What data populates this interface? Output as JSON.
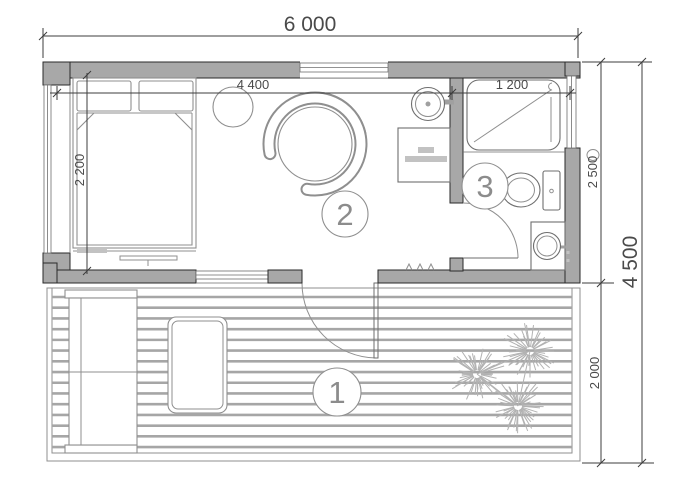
{
  "drawing": {
    "type": "architectural-floor-plan",
    "dimension_labels": {
      "width_total": "6 000",
      "interior_width": "4 400",
      "shower_width": "1 200",
      "bed_length": "2 200",
      "house_depth": "2 500",
      "depth_total": "4 500",
      "deck_depth": "2 000"
    },
    "room_labels": [
      {
        "number": "1"
      },
      {
        "number": "2"
      },
      {
        "number": "3"
      }
    ],
    "colors": {
      "background": "#ffffff",
      "wall_fill": "#a8a8a8",
      "wall_edge": "#2a2a2a",
      "furniture_line": "#8f8f8f",
      "fixture_line": "#6e6e6e",
      "dim_line": "#3d3d3d",
      "dim_text": "#4a4a4a",
      "room_label_text": "#8c8c8c",
      "plank_line": "#a6a6a6",
      "plant_color": "#b2b2b2",
      "item_fill": "#c2c2c2"
    }
  }
}
